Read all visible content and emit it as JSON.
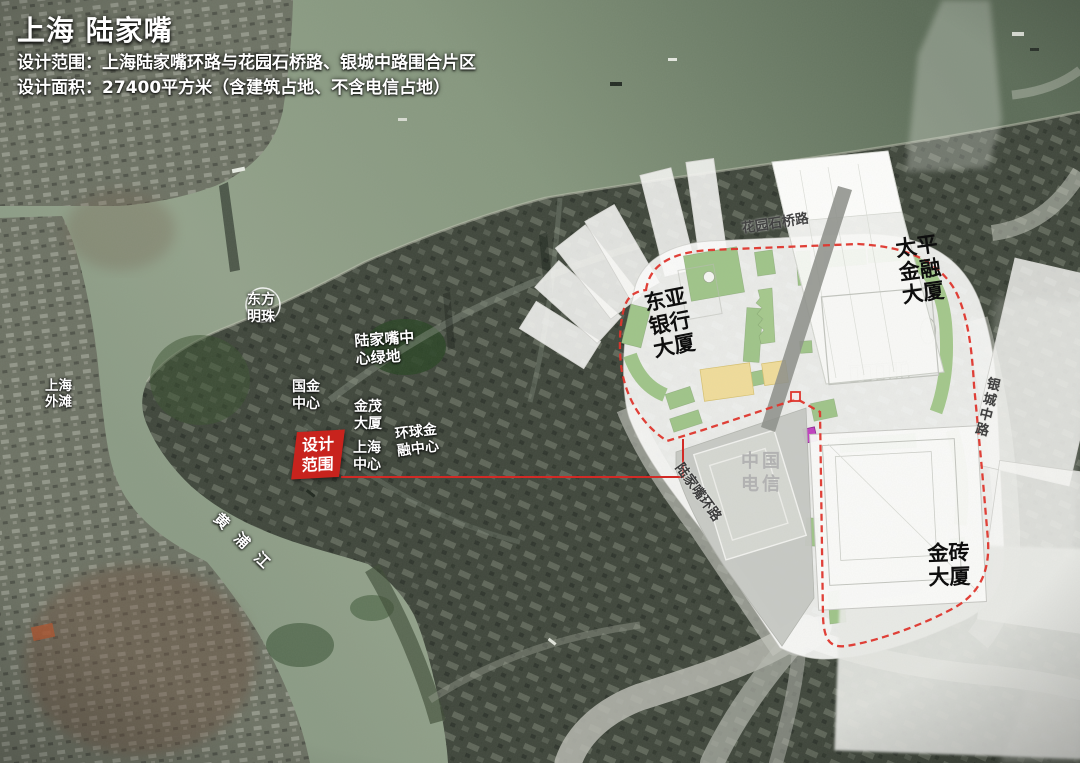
{
  "header": {
    "title": "上海 陆家嘴",
    "line1": "设计范围：上海陆家嘴环路与花园石桥路、银城中路围合片区",
    "line2": "设计面积：27400平方米（含建筑占地、不含电信占地）"
  },
  "map_labels": {
    "oriental_pearl": "东方明珠",
    "bund": "上海外滩",
    "lujiazui_green_space": "陆家嘴中心绿地",
    "guojin_center": "国金中心",
    "jinmao_tower": "金茂大厦",
    "world_financial_center": "环球金融中心",
    "shanghai_tower": "上海中心",
    "design_scope_tag": "设计范围",
    "huangpu_river": "黄浦江"
  },
  "plan_labels": {
    "garden_bridge_road": "花园石桥路",
    "east_asia_bank_tower": "东亚银行大厦",
    "taiping_finance_tower": "太平金融大厦",
    "yincheng_middle_road": "银城中路",
    "china_telecom": "中国电信",
    "lujiazui_ring_road": "陆家嘴环路",
    "golden_brick_tower": "金砖大厦"
  },
  "legend_colors": {
    "design_boundary_red": "#e03028",
    "scope_tag_red": "#c8231d",
    "site_green": "#9fc489",
    "site_yellow": "#f0dc9a",
    "accent_magenta": "#c040c0"
  }
}
